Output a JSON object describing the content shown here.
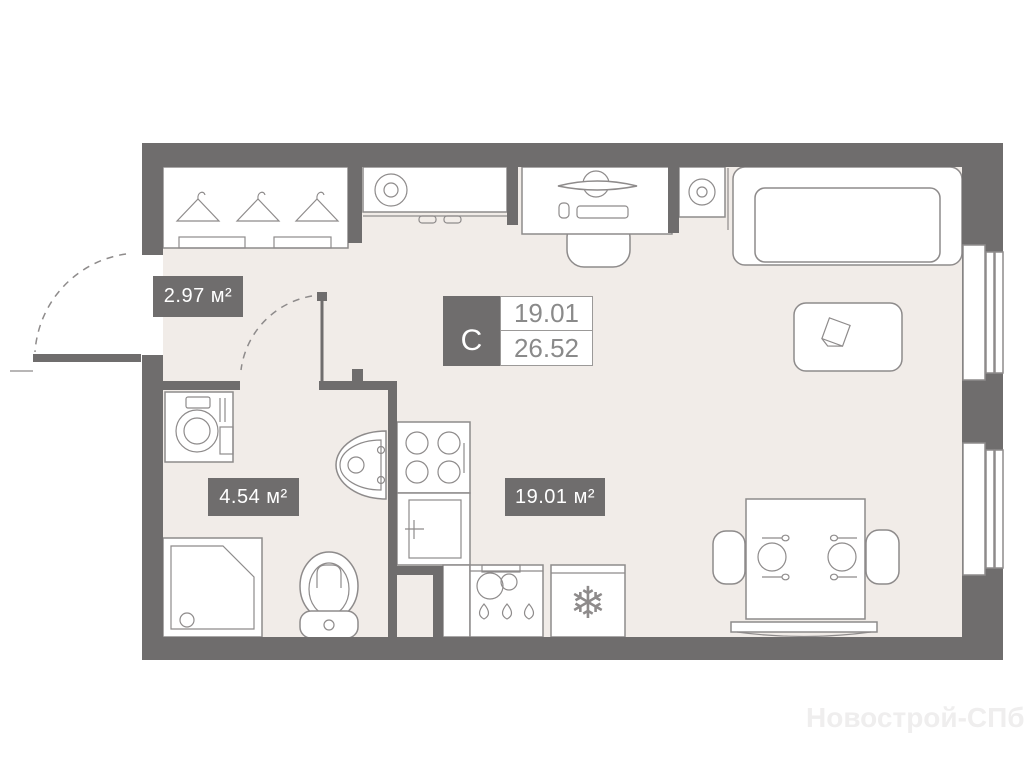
{
  "labels": {
    "hallway_area": "2.97 м²",
    "bathroom_area": "4.54 м²",
    "living_area": "19.01 м²"
  },
  "info_box": {
    "unit_type": "С",
    "living_area": "19.01",
    "total_area": "26.52"
  },
  "watermark": "Новострой-СПб",
  "icons": {
    "snowflake": "❄"
  },
  "colors": {
    "wall": "#6f6d6d",
    "floor": "#f1ece8",
    "outline": "#8e8b8b",
    "label_text": "#ffffff",
    "value_text": "#8a8a8a",
    "value_border": "#9b9998",
    "watermark": "#efeeee",
    "page_bg": "#ffffff"
  }
}
